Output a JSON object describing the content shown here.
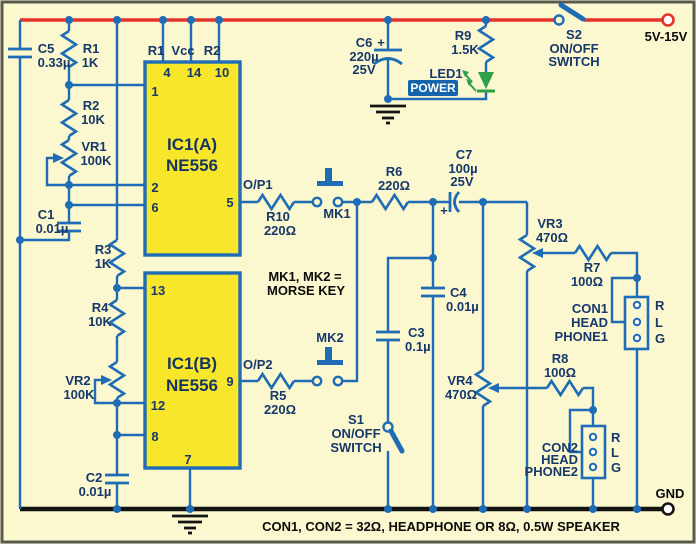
{
  "colors": {
    "bg": "#fbf7cf",
    "wire": "#1e6cb5",
    "rail": "#e3342b",
    "bus": "#141414",
    "icfill": "#f8e62b",
    "text": "#16386b",
    "ann": "#0b0b0b",
    "green": "#2fa045",
    "badge": "#1464ad",
    "frame": "#585a50"
  },
  "supply": {
    "positive": "5V-15V",
    "ground": "GND"
  },
  "switches": {
    "s2": {
      "name": "S2",
      "line1": "ON/OFF",
      "line2": "SWITCH"
    },
    "s1": {
      "name": "S1",
      "line1": "ON/OFF",
      "line2": "SWITCH"
    }
  },
  "ics": {
    "a": {
      "name": "IC1(A)",
      "part": "NE556",
      "top_nets": {
        "left": "R1",
        "mid": "Vcc",
        "right": "R2"
      },
      "top_pins": {
        "p4": "4",
        "p14": "14",
        "p10": "10"
      },
      "left_pins": {
        "p1": "1",
        "p2": "2",
        "p6": "6"
      },
      "right_pins": {
        "p5": "5"
      }
    },
    "b": {
      "name": "IC1(B)",
      "part": "NE556",
      "left_pins": {
        "p13": "13",
        "p12": "12",
        "p8": "8"
      },
      "right_pins": {
        "p9": "9"
      },
      "bottom_pins": {
        "p7": "7"
      }
    }
  },
  "resistors": {
    "r1": {
      "name": "R1",
      "value": "1K"
    },
    "r2": {
      "name": "R2",
      "value": "10K"
    },
    "r3": {
      "name": "R3",
      "value": "1K"
    },
    "r4": {
      "name": "R4",
      "value": "10K"
    },
    "r5": {
      "name": "R5",
      "value": "220Ω"
    },
    "r6": {
      "name": "R6",
      "value": "220Ω"
    },
    "r7": {
      "name": "R7",
      "value": "100Ω"
    },
    "r8": {
      "name": "R8",
      "value": "100Ω"
    },
    "r9": {
      "name": "R9",
      "value": "1.5K"
    },
    "r10": {
      "name": "R10",
      "value": "220Ω"
    }
  },
  "potentiometers": {
    "vr1": {
      "name": "VR1",
      "value": "100K"
    },
    "vr2": {
      "name": "VR2",
      "value": "100K"
    },
    "vr3": {
      "name": "VR3",
      "value": "470Ω"
    },
    "vr4": {
      "name": "VR4",
      "value": "470Ω"
    }
  },
  "capacitors": {
    "c1": {
      "name": "C1",
      "value": "0.01µ"
    },
    "c2": {
      "name": "C2",
      "value": "0.01µ"
    },
    "c3": {
      "name": "C3",
      "value": "0.1µ"
    },
    "c4": {
      "name": "C4",
      "value": "0.01µ"
    },
    "c5": {
      "name": "C5",
      "value": "0.33µ"
    },
    "c6": {
      "name": "C6",
      "value": "220µ",
      "voltage": "25V",
      "polarity": "+"
    },
    "c7": {
      "name": "C7",
      "value": "100µ",
      "voltage": "25V",
      "polarity": "+"
    }
  },
  "led": {
    "name": "LED1",
    "badge": "POWER"
  },
  "outputs": {
    "op1": "O/P1",
    "op2": "O/P2"
  },
  "morse_keys": {
    "mk1": "MK1",
    "mk2": "MK2"
  },
  "connectors": {
    "con1": {
      "line1": "CON1",
      "line2": "HEAD",
      "line3": "PHONE1",
      "pins": {
        "r": "R",
        "l": "L",
        "g": "G"
      }
    },
    "con2": {
      "line1": "CON2",
      "line2": "HEAD",
      "line3": "PHONE2",
      "pins": {
        "r": "R",
        "l": "L",
        "g": "G"
      }
    }
  },
  "notes": {
    "morse_line1": "MK1, MK2 =",
    "morse_line2": "MORSE KEY",
    "bottom_caption": "CON1, CON2 = 32Ω, HEADPHONE OR 8Ω, 0.5W SPEAKER"
  }
}
